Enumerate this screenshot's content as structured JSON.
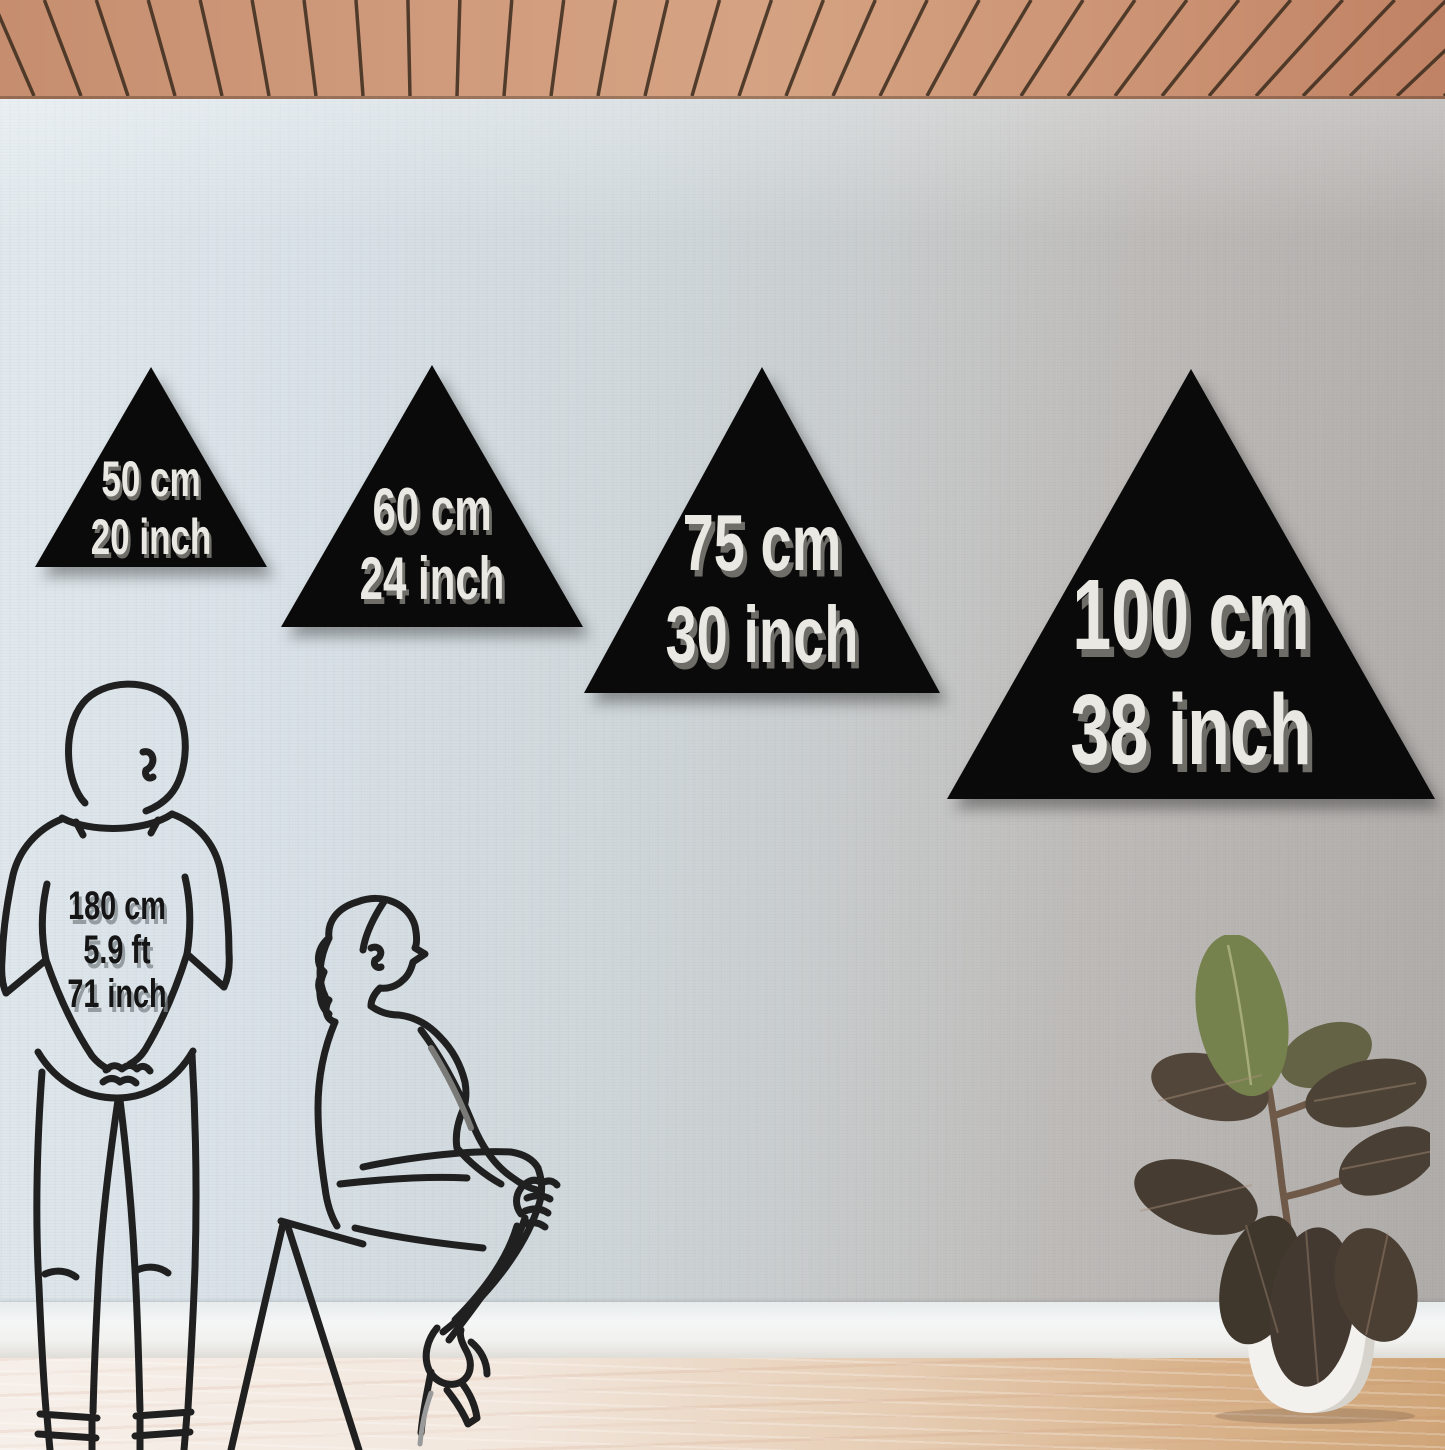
{
  "triangles": [
    {
      "cm_label": "50 cm",
      "inch_label": "20 inch"
    },
    {
      "cm_label": "60 cm",
      "inch_label": "24 inch"
    },
    {
      "cm_label": "75 cm",
      "inch_label": "30 inch"
    },
    {
      "cm_label": "100 cm",
      "inch_label": "38 inch"
    }
  ],
  "person_reference": {
    "height_cm": "180 cm",
    "height_ft": "5.9 ft",
    "height_inch": "71 inch"
  },
  "colors": {
    "triangle_fill": "#0a0a0a",
    "triangle_text": "#e9e8e3",
    "triangle_text_shadow": "#6e6d68",
    "reference_text": "#151515",
    "line_art": "#202020",
    "wall_left": "#dde6ec",
    "wall_right": "#aeaba8",
    "baseboard": "#f2f4f4",
    "ceiling_wood": "#cd9678",
    "ceiling_slat_gap": "#3b2b1d",
    "floor_light": "#f5efe9",
    "floor_warm": "#cfa578",
    "pot": "#f3f1ed",
    "leaf_green": "#76824e",
    "leaf_dark": "#463d33"
  }
}
